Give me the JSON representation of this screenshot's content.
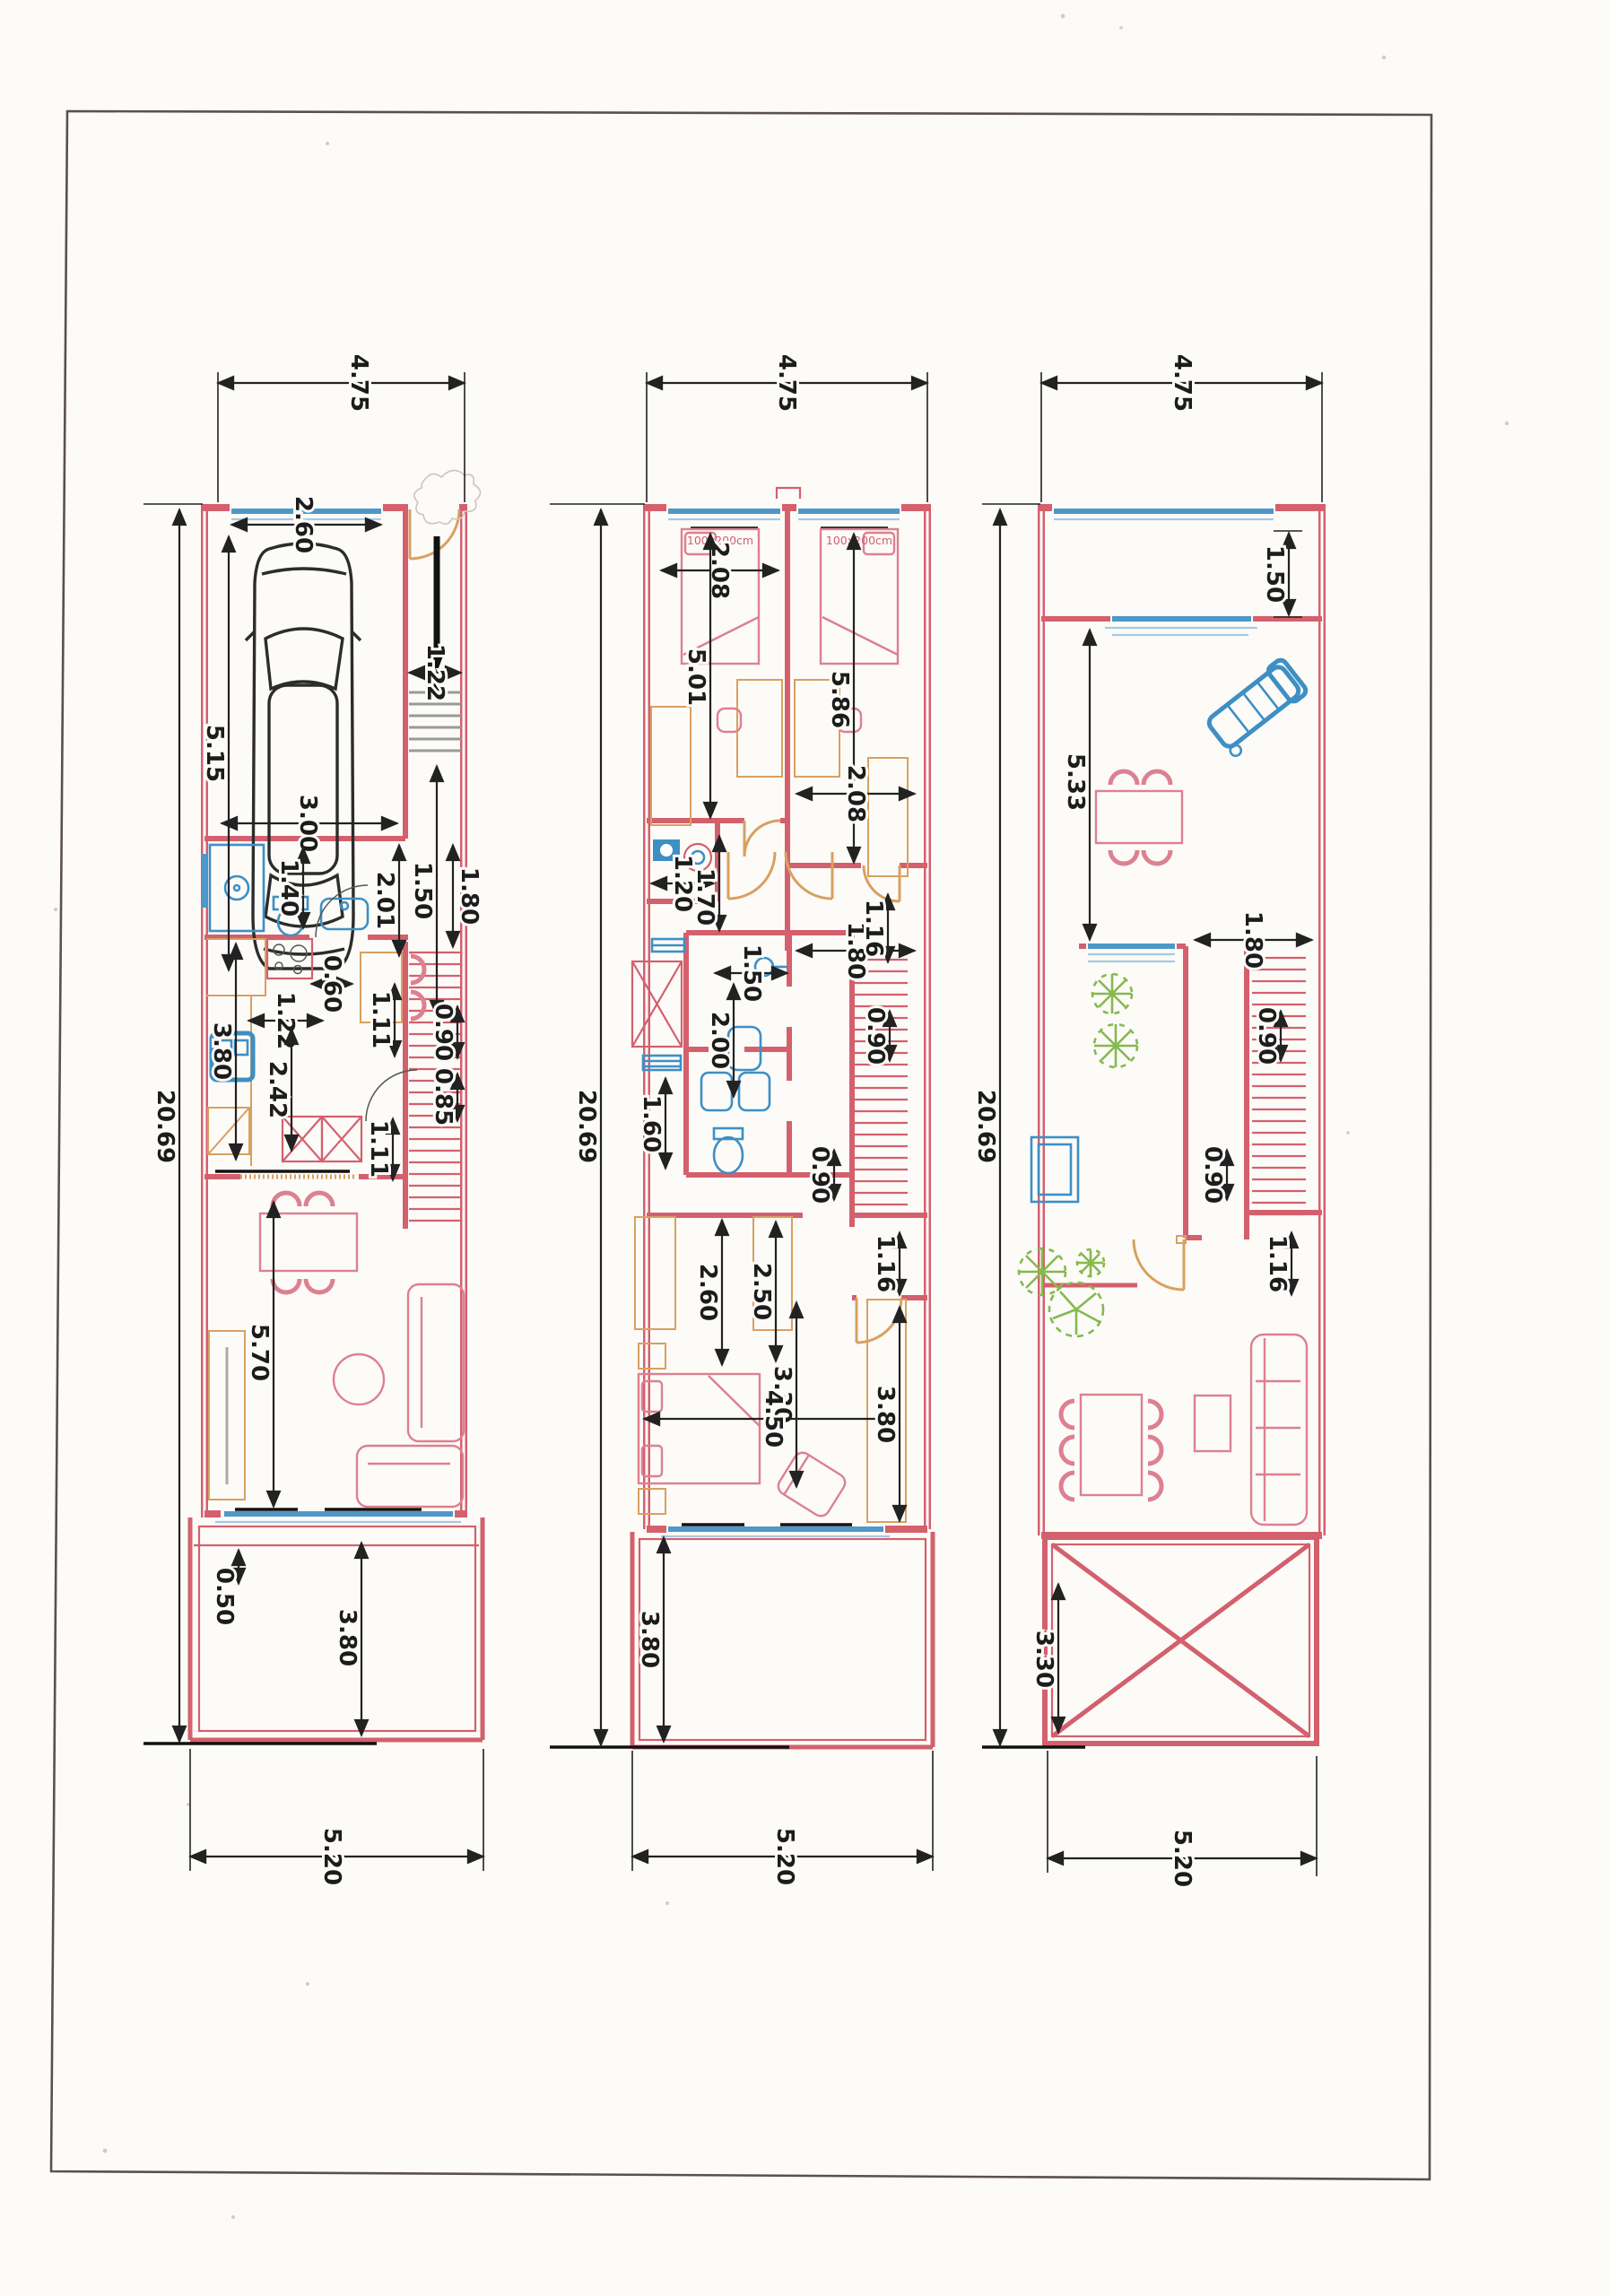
{
  "sheet": {
    "kind": "scanned architectural floor plan, three stacked-house levels side by side",
    "page_background": "#fcfbf8",
    "border_color": "#5a504c"
  },
  "colors": {
    "wall": "#d4606d",
    "furniture_pink": "#dd8090",
    "wood_orange": "#d9a05f",
    "glass_blue": "#4f97c8",
    "fixture_blue": "#3e8fc4",
    "plant_green": "#86b94e",
    "dimension_black": "#222222"
  },
  "plans": {
    "left": {
      "name": "ground-floor-plan",
      "labels": {
        "width_top": "4.75",
        "garage_door_width": "2.60",
        "garage_length": "5.15",
        "garage_width": "3.00",
        "stair_width": "1.22",
        "stair_landing": "1.50",
        "bath_width": "1.40",
        "hall_length": "2.01",
        "entry_width": "1.80",
        "counter_depth": "0.60",
        "kitchen_width": "1.22",
        "kitchen_length": "3.80",
        "cabinet_width": "2.42",
        "hall_width_upper": "1.11",
        "stair_flight_width": "0.90",
        "stair_run": "0.85",
        "hall_width_lower": "1.11",
        "living_length": "5.70",
        "planter_depth": "0.50",
        "yard_length": "3.80",
        "width_bottom": "5.20",
        "total_length": "20.69"
      }
    },
    "middle": {
      "name": "first-floor-plan",
      "labels": {
        "width_top": "4.75",
        "bed1_width": "2.08",
        "bed1_size": "100x200cm",
        "bed2_size": "100x200cm",
        "bedroom1_length": "5.01",
        "bedroom2_length": "5.86",
        "bed2_width": "2.08",
        "wc_width": "1.20",
        "wc_length": "1.70",
        "bath_width": "1.50",
        "bath_length": "2.00",
        "bath2_width": "1.60",
        "landing_width": "1.80",
        "corridor_width": "1.16",
        "stair_flight_width": "0.90",
        "stair_flight_width2": "0.90",
        "wardrobe_length": "2.60",
        "wardrobe2_length": "2.50",
        "closet_door_width": "1.16",
        "bedroom3_width": "3.30",
        "bedroom3_length": "4.50",
        "bedroom3_side": "3.80",
        "yard_length": "3.80",
        "width_bottom": "5.20",
        "total_length": "20.69"
      }
    },
    "right": {
      "name": "roof-terrace-plan",
      "labels": {
        "width_top": "4.75",
        "balcony_depth": "1.50",
        "terrace_length": "5.33",
        "opening_width": "1.80",
        "stair_flight_width": "0.90",
        "stair_flight_width2": "0.90",
        "door_width": "1.16",
        "pergola_length": "3.30",
        "width_bottom": "5.20",
        "total_length": "20.69"
      }
    }
  }
}
